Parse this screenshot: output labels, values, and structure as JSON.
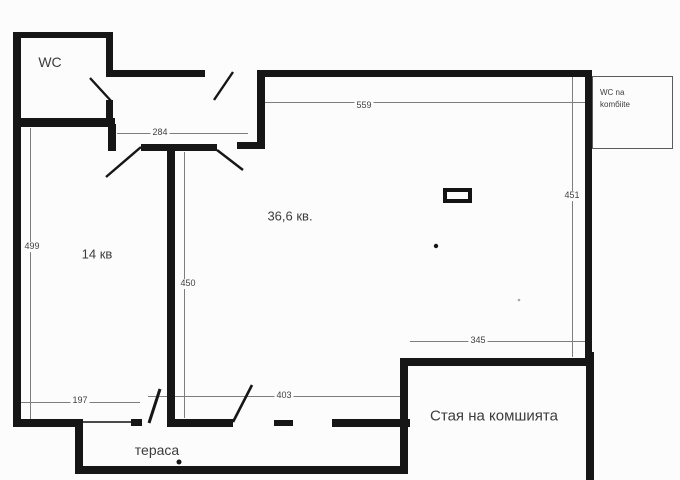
{
  "rooms": {
    "wc": "WC",
    "room_14": "14 кв",
    "room_366": "36,6 кв.",
    "neighbor": "Стая на комшията",
    "terrace": "тераса",
    "neighbor_wc_line1": "WC na",
    "neighbor_wc_line2": "komбiite"
  },
  "dimensions": {
    "top_width": "559",
    "hall_width": "284",
    "left_height": "499",
    "middle_height": "450",
    "right_height": "451",
    "bottom_left_width": "197",
    "bottom_middle_width": "403",
    "bottom_right_width": "345"
  }
}
